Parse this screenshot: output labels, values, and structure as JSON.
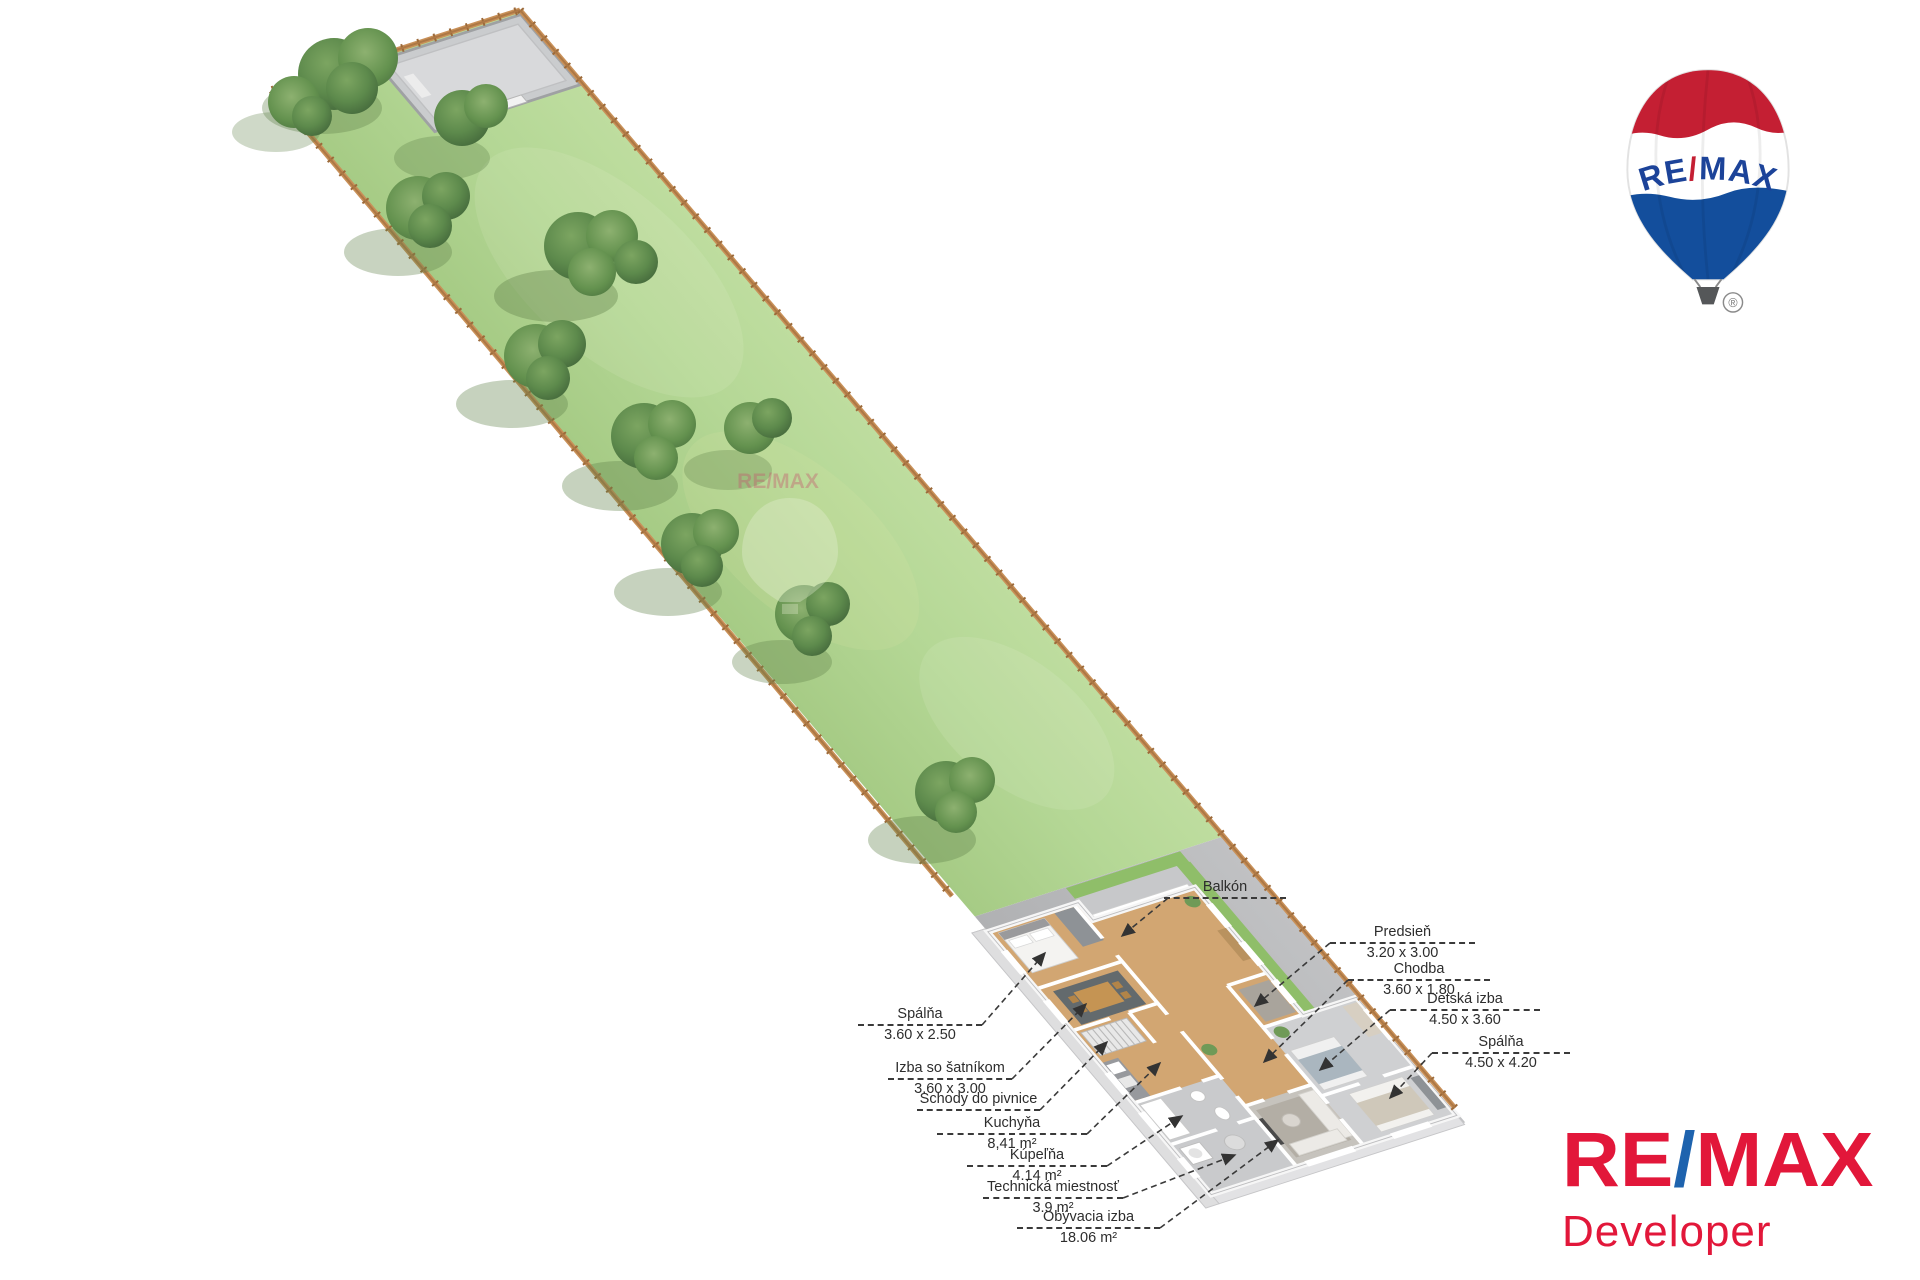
{
  "labels": {
    "balcony": {
      "title": "Balkón",
      "dims": ""
    },
    "left": [
      {
        "title": "Spálňa",
        "dims": "3.60 x 2.50"
      },
      {
        "title": "Izba so šatníkom",
        "dims": "3.60 x 3.00"
      },
      {
        "title": "Schody do pivnice",
        "dims": ""
      },
      {
        "title": "Kuchyňa",
        "dims": "8,41 m²"
      },
      {
        "title": "Kúpeľňa",
        "dims": "4.14 m²"
      },
      {
        "title": "Technická miestnosť",
        "dims": "3.9 m²"
      },
      {
        "title": "Obývacia izba",
        "dims": "18.06 m²"
      }
    ],
    "right": [
      {
        "title": "Predsieň",
        "dims": "3.20 x 3.00"
      },
      {
        "title": "Chodba",
        "dims": "3.60 x 1.80"
      },
      {
        "title": "Detská izba",
        "dims": "4.50 x 3.60"
      },
      {
        "title": "Spálňa",
        "dims": "4.50 x 4.20"
      }
    ]
  },
  "balloon_logo": {
    "re": "RE",
    "slash": "/",
    "max": "MAX",
    "registered": "®"
  },
  "developer_logo": {
    "re": "RE",
    "slash": "/",
    "max": "MAX",
    "subtitle": "Developer"
  },
  "watermark": {
    "text": "RE/MAX"
  },
  "colors": {
    "remax_red": "#e2173a",
    "remax_blue": "#1e63ae",
    "balloon_red": "#c41f33",
    "balloon_blue": "#134e9c",
    "grass": "#b0d391",
    "terrace_gray": "#b8b9bb",
    "fence_brown": "#ad7845",
    "wood_floor": "#d2a672"
  }
}
